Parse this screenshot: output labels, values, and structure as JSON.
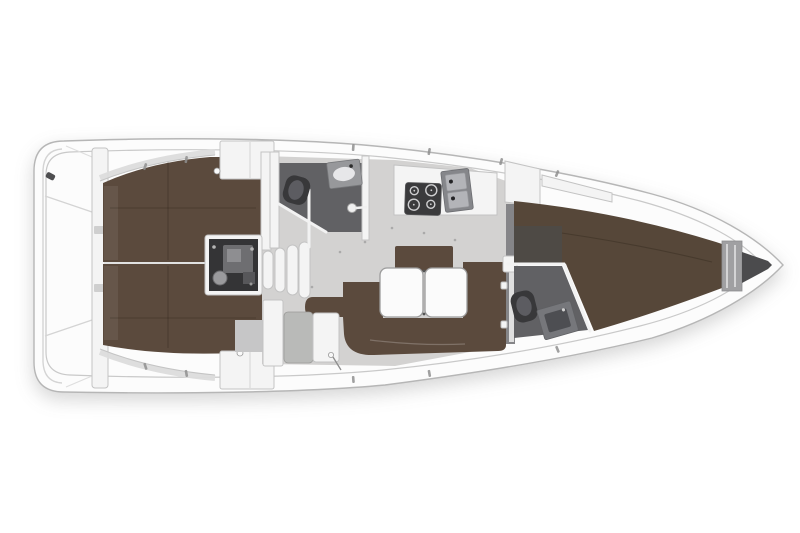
{
  "document": {
    "title": "",
    "visible_text": []
  },
  "scene": {
    "kind": "sailing-yacht-interior-floor-plan",
    "view": "top-down",
    "orientation": {
      "bow": "right",
      "stern": "left"
    },
    "areas": [
      "swim-platform",
      "transom",
      "aft-cabin-starboard",
      "aft-cabin-port",
      "engine-compartment",
      "companionway-steps",
      "aft-head",
      "saloon",
      "galley",
      "navigation-seat",
      "forward-head",
      "forward-cabin",
      "anchor-locker"
    ],
    "fixtures": [
      "aft-head-toilet",
      "aft-head-sink",
      "shower-fitting",
      "galley-stove",
      "galley-double-sink",
      "saloon-settee",
      "saloon-table",
      "saloon-backrest-seat",
      "forward-head-toilet",
      "forward-head-sink",
      "forward-berth",
      "aft-berth-port",
      "aft-berth-starboard",
      "bow-headboard"
    ]
  },
  "palette": {
    "background": "#ffffff",
    "hull_fill": "#fcfcfc",
    "hull_stroke": "#b6b6b6",
    "deck_line": "#c9c9c9",
    "floor": "#d3d2d1",
    "floor_dark": "#c6c6c7",
    "upholstery": "#5b4a3d",
    "upholstery_fwd": "#564739",
    "head_floor": "#616164",
    "fixture_dark": "#38383a",
    "fixture_mid": "#5c5c61",
    "steel": "#97989b",
    "basin": "#e7e7e9",
    "furniture_white": "#f4f4f4",
    "furniture_stroke": "#c3c3c3",
    "engine_dark": "#343436",
    "engine_mid": "#6e6e71",
    "engine_light": "#9a9a9d",
    "locker_dark": "#4b4b4d",
    "headboard": "#a0a0a2",
    "table_fill": "#fbfbfb",
    "table_stroke": "#9c9c9c",
    "tick": "#8f8f8f",
    "vanity_dark": "#4e4a45"
  }
}
